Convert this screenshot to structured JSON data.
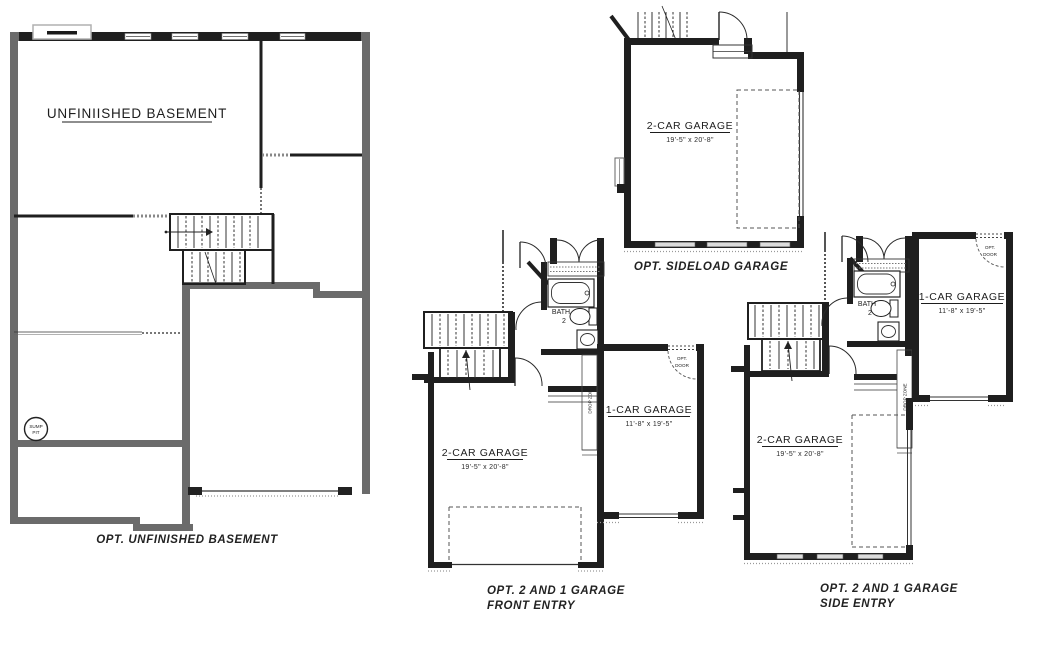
{
  "plans": {
    "basement": {
      "label": "UNFINIISHED BASEMENT",
      "sump": {
        "line1": "SUMP",
        "line2": "PIT"
      },
      "caption": "OPT. UNFINISHED BASEMENT"
    },
    "sideload": {
      "garage": {
        "label": "2-CAR GARAGE",
        "dims": "19'-5\" x 20'-8\""
      },
      "caption": "OPT. SIDELOAD GARAGE"
    },
    "front_entry": {
      "two_car": {
        "label": "2-CAR GARAGE",
        "dims": "19'-5\" x 20'-8\""
      },
      "one_car": {
        "label": "1-CAR GARAGE",
        "dims": "11'-8\" x 19'-5\""
      },
      "bath": {
        "line1": "BATH",
        "line2": "2"
      },
      "drop_zone": "DROP ZONE",
      "opt_door": {
        "line1": "OPT.",
        "line2": "DOOR"
      },
      "caption": {
        "line1": "OPT. 2 AND 1 GARAGE",
        "line2": "FRONT ENTRY"
      }
    },
    "side_entry": {
      "two_car": {
        "label": "2-CAR GARAGE",
        "dims": "19'-5\" x 20'-8\""
      },
      "one_car": {
        "label": "1-CAR GARAGE",
        "dims": "11'-8\" x 19'-5\""
      },
      "bath": {
        "line1": "BATH",
        "line2": "2"
      },
      "drop_zone": "DROP ZONE",
      "opt_door": {
        "line1": "OPT.",
        "line2": "DOOR"
      },
      "caption": {
        "line1": "OPT. 2 AND 1 GARAGE",
        "line2": "SIDE ENTRY"
      }
    }
  }
}
